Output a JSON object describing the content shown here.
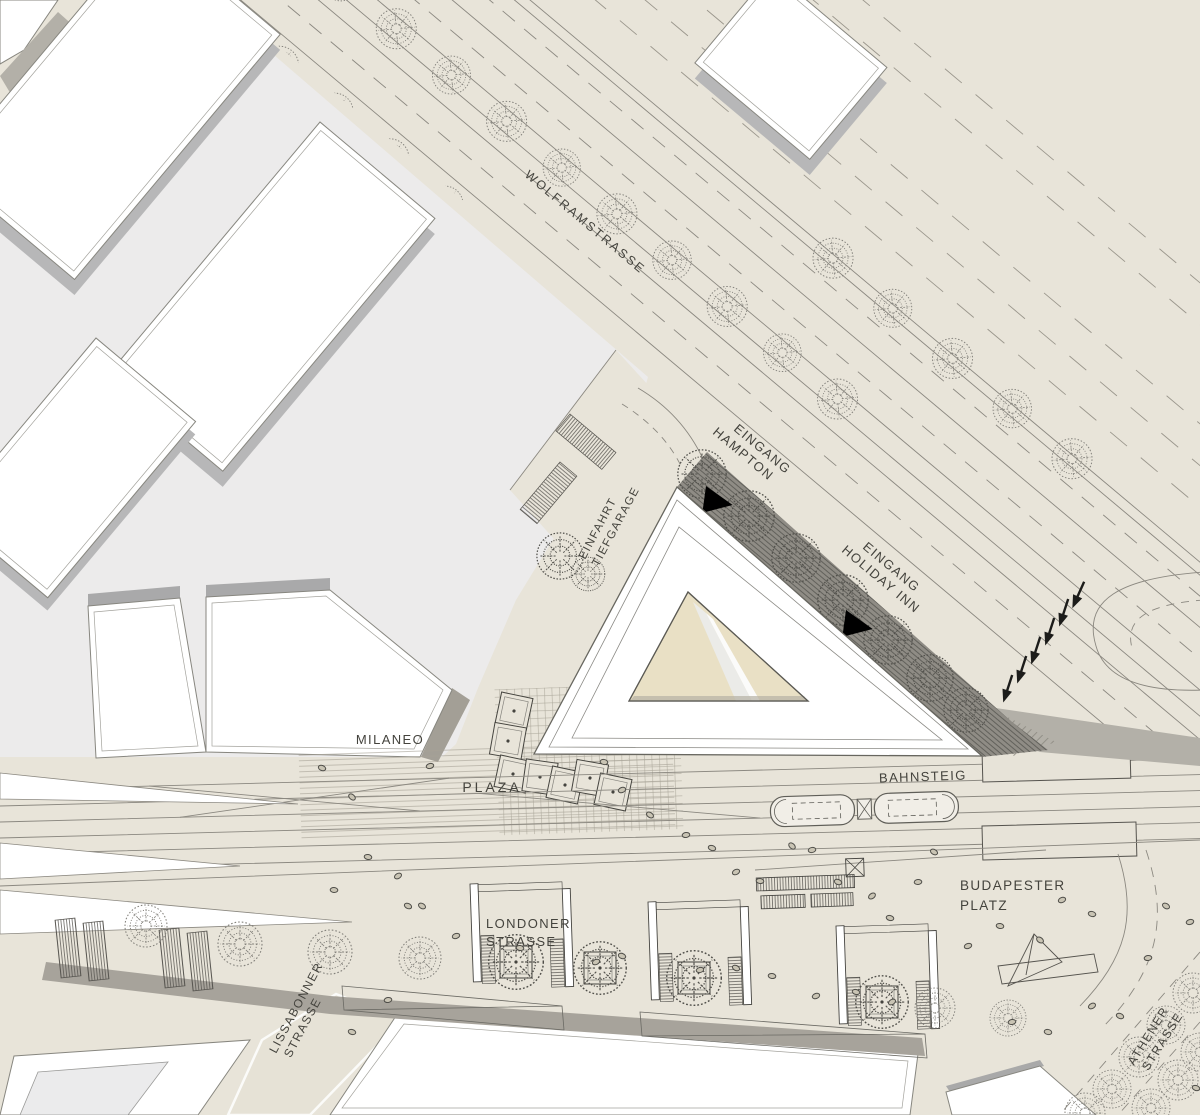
{
  "map": {
    "streets": {
      "wolframstrasse": "WOLFRAMSTRASSE",
      "londoner_strasse": [
        "LONDONER",
        "STRASSE"
      ],
      "lissabonner_strasse": [
        "LISSABONNER",
        "STRASSE"
      ],
      "athener_strasse": [
        "ATHENER",
        "STRASSE"
      ]
    },
    "places": {
      "milaneo": "MILANEO",
      "plaza": "PLAZA",
      "bahnsteig": "BAHNSTEIG",
      "budapester_platz": [
        "BUDAPESTER",
        "PLATZ"
      ]
    },
    "entrances": {
      "eingang_hampton": [
        "EINGANG",
        "HAMPTON"
      ],
      "eingang_holiday_inn": [
        "EINGANG",
        "HOLIDAY INN"
      ],
      "einfahrt_tiefgarage": [
        "EINFAHRT",
        "TIEFGARAGE"
      ]
    },
    "colors": {
      "background": "#e8e4d9",
      "block_gray": "#ecebeb",
      "building_white": "#ffffff",
      "sidewalk_gray": "#b3b0a8",
      "arcade_dark": "#8f8c85",
      "courtyard_tan": "#e9e0c5",
      "shadow_gray": "#b7b7b8",
      "line_gray": "#8b8880",
      "label_ink": "#44433d"
    }
  }
}
